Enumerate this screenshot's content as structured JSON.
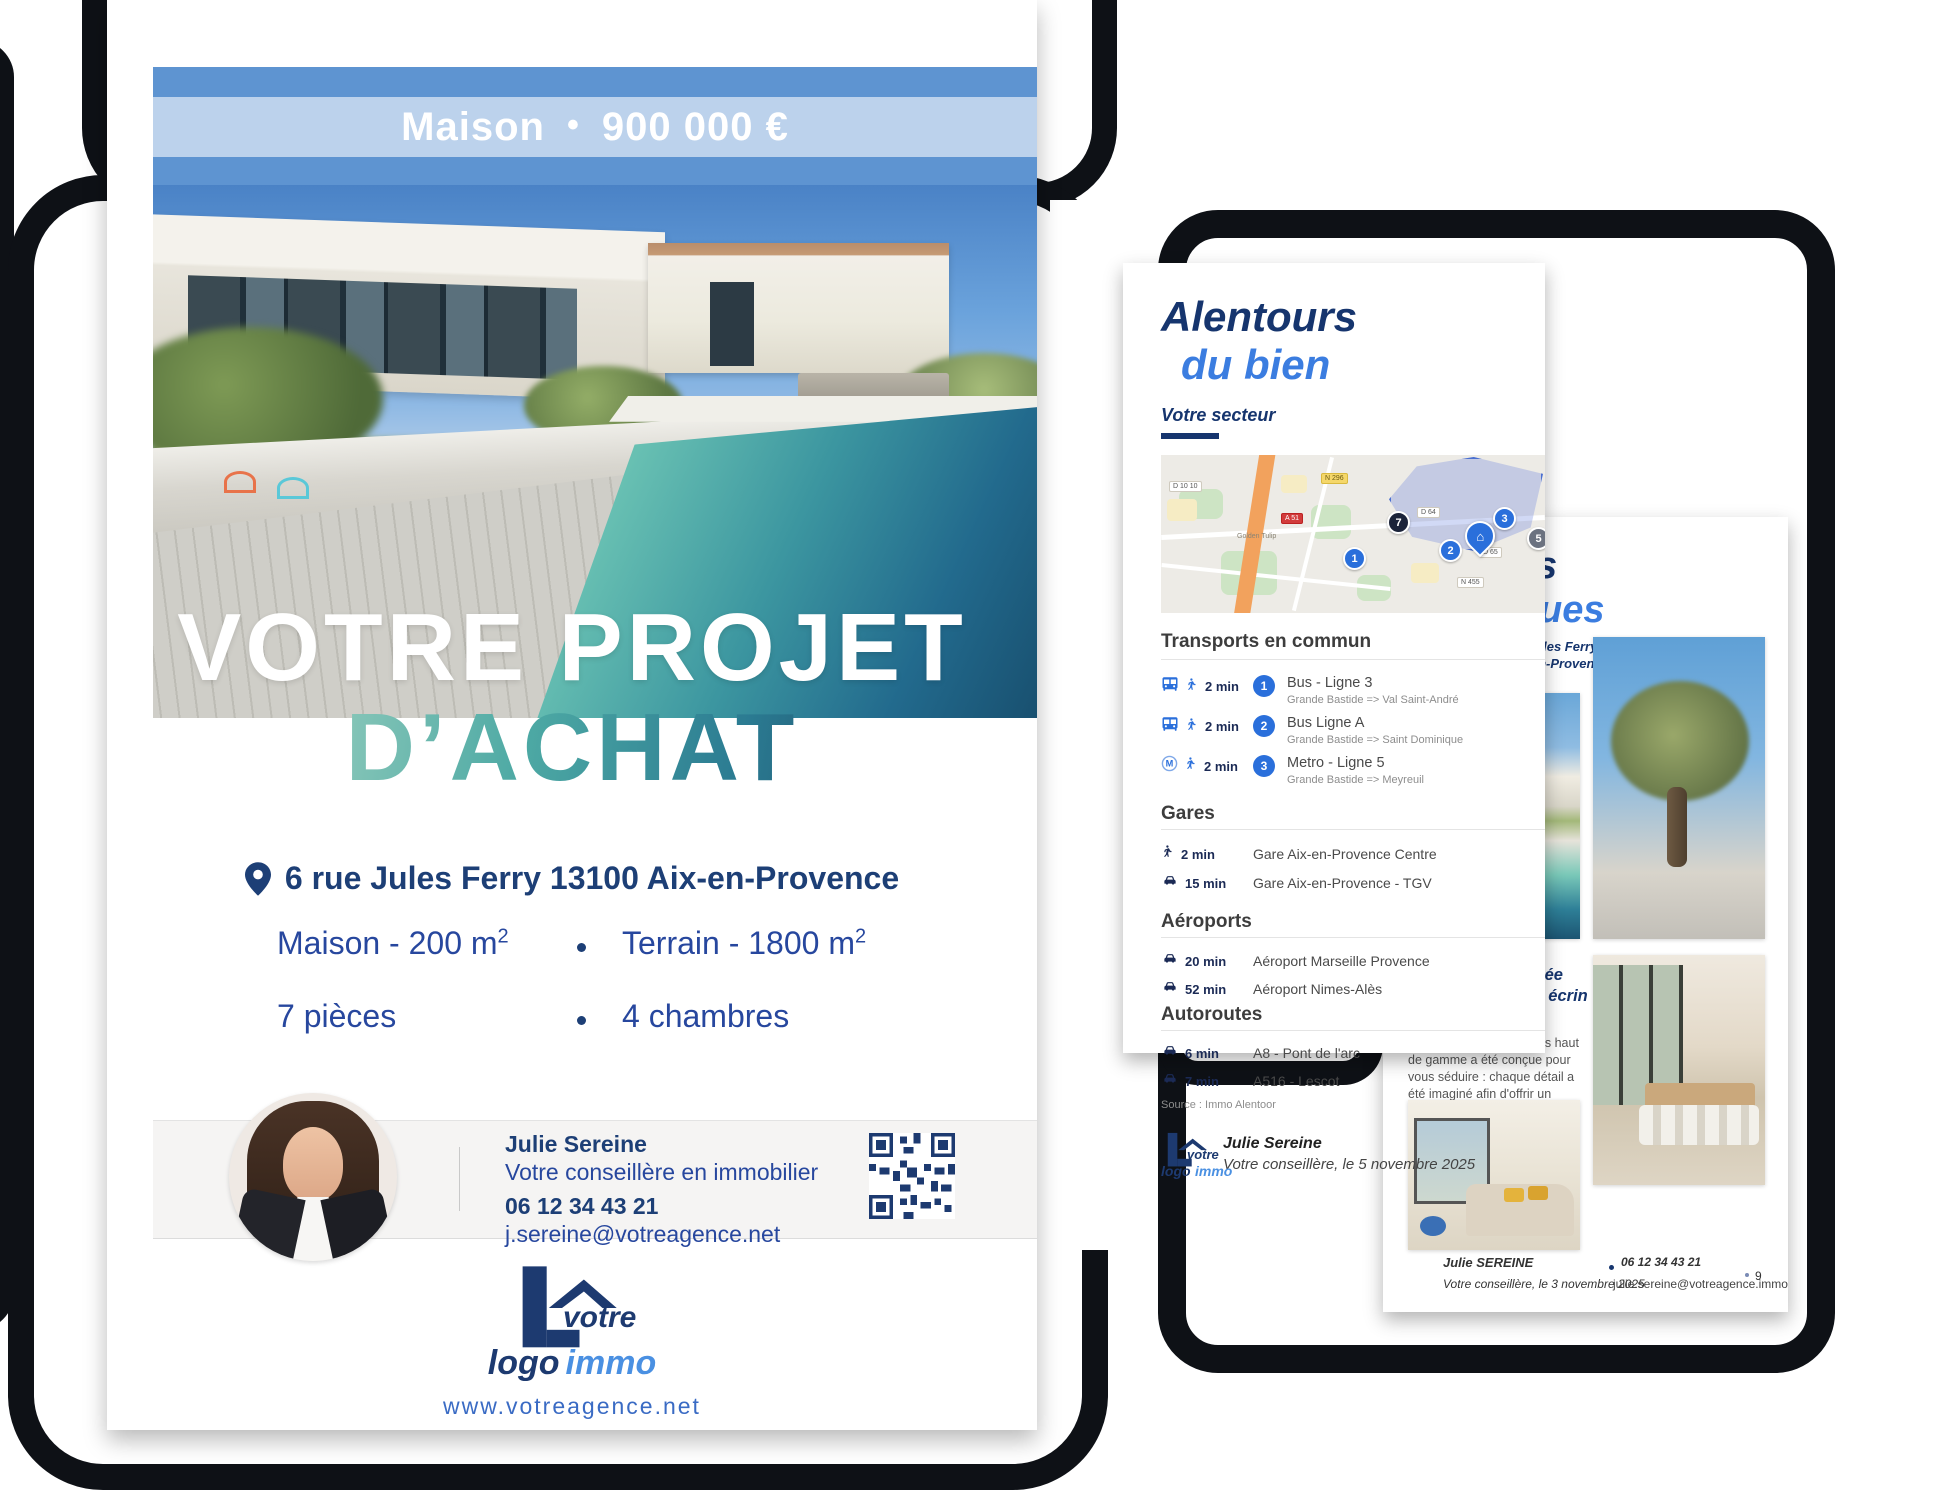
{
  "brand": {
    "accent": "#3b7de0",
    "navy": "#16356e",
    "logo_word1": "votre",
    "logo_word2_dark": "logo",
    "logo_word2_blue": "immo",
    "website": "www.votreagence.net"
  },
  "main_page": {
    "banner": {
      "label": "Maison",
      "separator": "•",
      "price": "900 000 €"
    },
    "title_line1": "VOTRE PROJET",
    "title_line2": "D’ACHAT",
    "address": "6 rue Jules Ferry 13100 Aix-en-Provence",
    "details": {
      "surface": "Maison - 200 m",
      "surface_sup": "2",
      "terrain": "Terrain - 1800 m",
      "terrain_sup": "2",
      "rooms": "7 pièces",
      "bedrooms": "4 chambres"
    },
    "agent": {
      "name": "Julie Sereine",
      "role": "Votre conseillère en immobilier",
      "phone": "06 12 34 43 21",
      "email": "j.sereine@votreagence.net"
    }
  },
  "surroundings_page": {
    "title_line1": "Alentours",
    "title_line2": "du bien",
    "section_label": "Votre secteur",
    "map": {
      "chips": [
        "D 10 10",
        "N 296",
        "A 51",
        "D 64",
        "D 65",
        "N 455"
      ],
      "poi": "Golden Tulip",
      "badge_7": "7",
      "badge_1": "1",
      "badge_2": "2",
      "badge_3": "3",
      "badge_5": "5",
      "home_icon": "⌂"
    },
    "transit": {
      "heading": "Transports en commun",
      "rows": [
        {
          "time": "2 min",
          "badge": "1",
          "name": "Bus - Ligne 3",
          "route": "Grande Bastide => Val Saint-André"
        },
        {
          "time": "2 min",
          "badge": "2",
          "name": "Bus Ligne A",
          "route": "Grande Bastide => Saint Dominique"
        },
        {
          "time": "2 min",
          "badge": "3",
          "name": "Metro - Ligne 5",
          "route": "Grande Bastide => Meyreuil"
        }
      ]
    },
    "stations": {
      "heading": "Gares",
      "rows": [
        {
          "time": "2 min",
          "name": "Gare Aix-en-Provence Centre"
        },
        {
          "time": "15 min",
          "name": "Gare Aix-en-Provence - TGV"
        }
      ]
    },
    "airports": {
      "heading": "Aéroports",
      "rows": [
        {
          "time": "20 min",
          "name": "Aéroport Marseille Provence"
        },
        {
          "time": "52 min",
          "name": "Aéroport Nimes-Alès"
        }
      ]
    },
    "highways": {
      "heading": "Autoroutes",
      "rows": [
        {
          "time": "6 min",
          "name": "A8 - Pont de l'arc"
        },
        {
          "time": "7 min",
          "name": "A516 - Lescot"
        }
      ]
    },
    "source": "Source : Immo Alentoor",
    "signature": {
      "name": "Julie Sereine",
      "line": "Votre conseillère, le 5 novembre 2025"
    }
  },
  "photos_page": {
    "title_line1": "Prises",
    "title_line2": "de vues",
    "address_line1": "6 Avenue Jules Ferry",
    "address_line2": "13100 Aix-en-Provence",
    "caption_title": "Une maison, nichée dans un véritable écrin",
    "caption_body": "Cette villa aux prestations haut de gamme a été conçue pour vous séduire : chaque détail a été imaginé afin d'offrir un confort d'exception.",
    "footer": {
      "name": "Julie SEREINE",
      "line": "Votre conseillère, le 3 novembre 2025",
      "phone": "06 12 34 43 21",
      "email": "julie.sereine@votreagence.immo",
      "page": "9"
    }
  }
}
